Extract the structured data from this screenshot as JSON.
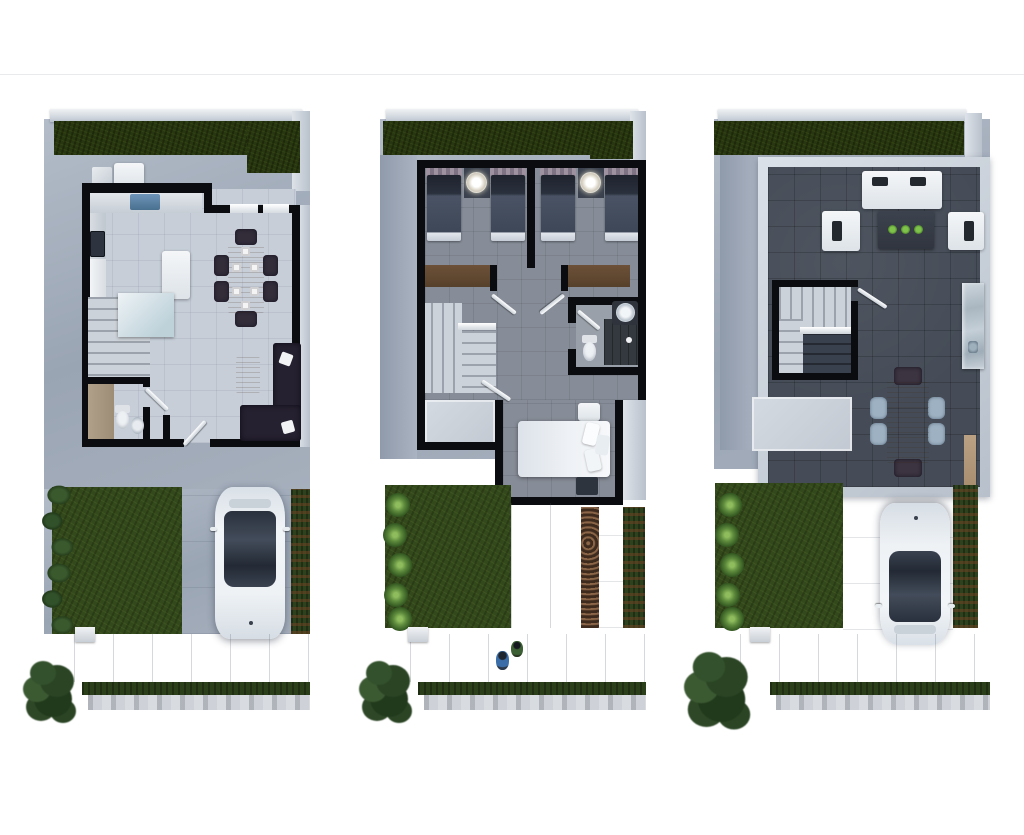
{
  "page": {
    "background": "#ffffff",
    "divider_color": "#e9eaec",
    "description": "Three 3D-rendered top-down floor plans of a two-storey house with roof terrace, shown side by side on a white background"
  },
  "plans": [
    {
      "id": "ground-floor-plan",
      "label": "Ground floor",
      "rooms": [
        "kitchen",
        "dining area",
        "living area",
        "half bathroom",
        "staircase",
        "front yard",
        "driveway"
      ],
      "objects": [
        "kitchen counter with sink",
        "stove",
        "refrigerator",
        "kitchen island",
        "dining table with six chairs and place settings",
        "L-shaped dark sofa",
        "coffee table",
        "toilet",
        "wash basin",
        "stairs",
        "back patio cabinets",
        "lawn",
        "shrub border",
        "white car on driveway",
        "side hedge",
        "sidewalk",
        "street hedge strip",
        "tree"
      ]
    },
    {
      "id": "upper-floor-plan",
      "label": "Upper floor",
      "rooms": [
        "bedroom 1",
        "bedroom 2",
        "shared bathroom",
        "master bedroom",
        "hallway",
        "staircase",
        "rear garden"
      ],
      "objects": [
        "four twin beds with dark bedding",
        "two round ceiling lamps",
        "window valances",
        "wood wardrobes",
        "stairs with landing",
        "toilet",
        "round sink",
        "dark tiled shower",
        "white master bed with pillows",
        "nightstands",
        "entry porch roof slab",
        "lawn with shrubs",
        "paved path",
        "gravel strip",
        "side hedge",
        "sidewalk with two pedestrians",
        "tree"
      ]
    },
    {
      "id": "roof-terrace-plan",
      "label": "Roof terrace",
      "rooms": [
        "open lounge",
        "outdoor dining",
        "bar ledge",
        "stairwell",
        "rear garden",
        "driveway"
      ],
      "objects": [
        "white outdoor sofa with dark cushions",
        "two white armchairs",
        "dark coffee table with three green plants",
        "stairwell with railing",
        "wood dining table with six chairs",
        "marble bar counter",
        "dark tiled terrace floor",
        "parapet walls",
        "lawn with shrubs",
        "white car on driveway",
        "side hedge",
        "sidewalk",
        "tree"
      ]
    }
  ],
  "colors": {
    "wall_black": "#0b0c0f",
    "concrete_apron": "#a3adbb",
    "floor_ground": "#c7ced8",
    "floor_upper": "#878d98",
    "floor_terrace": "#454c57",
    "grass_dark": "#28370f",
    "lawn": "#33491b",
    "hedge": "#2d421c",
    "wood": "#9c7d58",
    "car_body": "#eef2f5",
    "car_glass": "#2a313d",
    "bed_dark": "#3e4757",
    "bed_white": "#e6ebf1",
    "plant_green": "#5f9e3a"
  }
}
